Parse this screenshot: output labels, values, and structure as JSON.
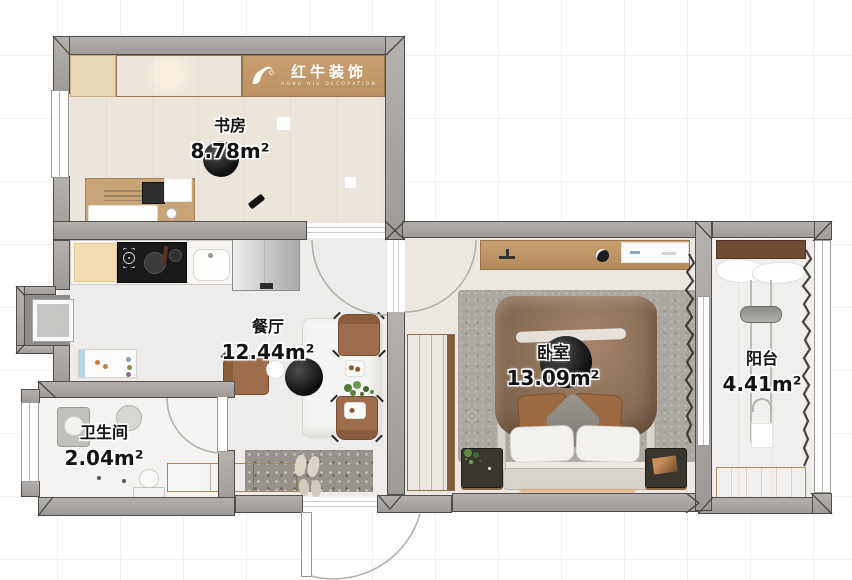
{
  "brand": {
    "name": "红牛装饰",
    "subtitle": "HONG NIU DECORATION",
    "logo_icon": "bull-icon"
  },
  "rooms": [
    {
      "id": "study",
      "name": "书房",
      "area": "8.78m²"
    },
    {
      "id": "dining",
      "name": "餐厅",
      "area": "12.44m²"
    },
    {
      "id": "bedroom",
      "name": "卧室",
      "area": "13.09m²"
    },
    {
      "id": "balcony",
      "name": "阳台",
      "area": "4.41m²"
    },
    {
      "id": "bathroom",
      "name": "卫生间",
      "area": "2.04m²"
    }
  ],
  "palette": {
    "wall_gray": "#a6a3a0",
    "floor_light": "#edecea",
    "wood_cabinet": "#c8a179",
    "wood_dark": "#6f4c33",
    "wood_light": "#ddbb90",
    "rug_gray": "#aba7a1",
    "duvet_brown": "#876b52",
    "chair_brown": "#9d6d4c",
    "pendant_black": "#111111",
    "logo_band": "#c49a6c"
  }
}
